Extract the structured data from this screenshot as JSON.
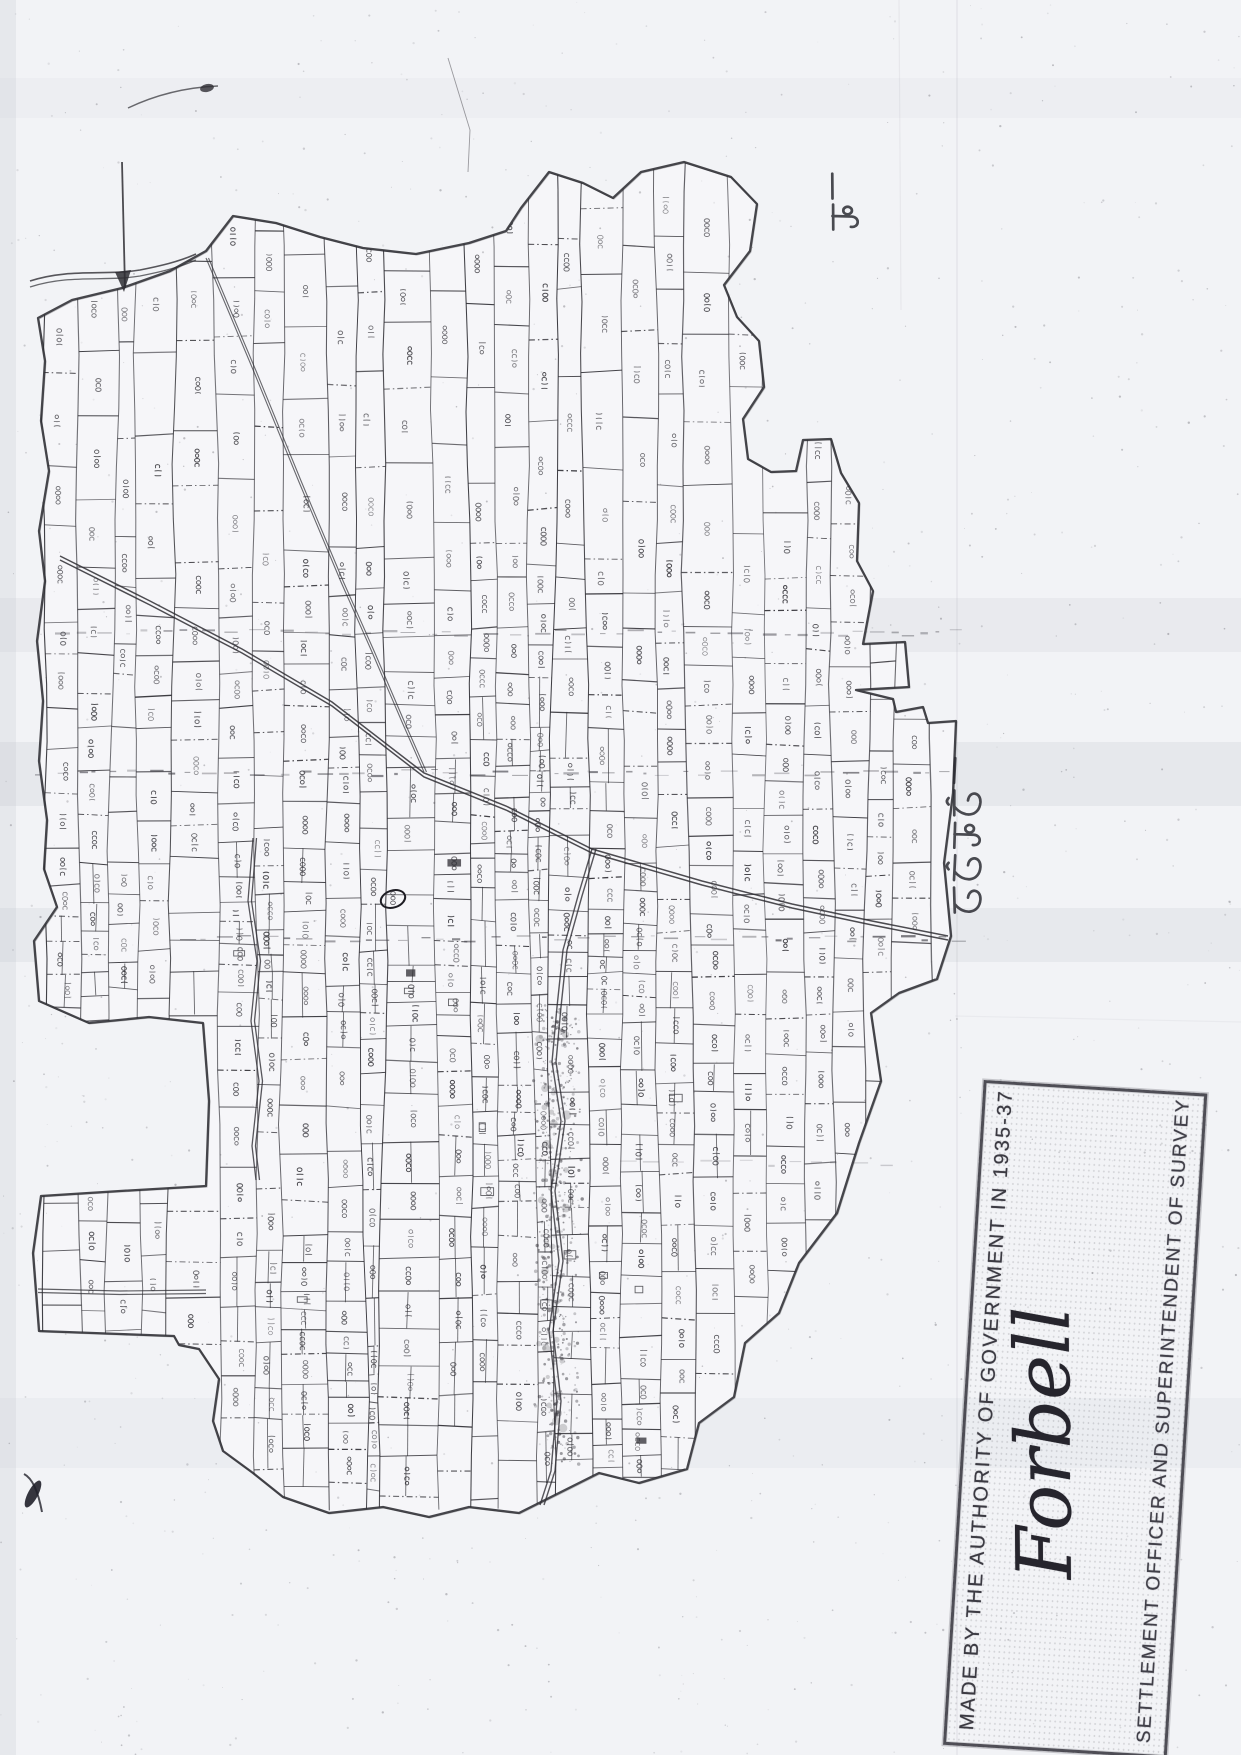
{
  "page": {
    "width": 1241,
    "height": 1755,
    "paper_color": "#f2f3f6",
    "ink_color": "#2e2d33",
    "kind_visible": "photocopied hand-drawn cadastral (mouza) plot map"
  },
  "map": {
    "region_labels": [
      {
        "id": "north-adjacent-mouza",
        "text": "ভাদগাঁও নং ৫",
        "orientation": "vertical, reads bottom-to-top",
        "position": "top-right edge"
      },
      {
        "id": "east-adjacent-mouza",
        "text": "ভেড়তৈল নং ২১",
        "orientation": "vertical, reads bottom-to-top",
        "position": "middle-right edge"
      }
    ],
    "circled_plot_number": "৩৬০৯",
    "parcel_number_script": "Bengali numerals, written rotated 90° (read bottom-to-top)",
    "legible_parcel_numbers_sample": [
      "৬৬৩",
      "৬৬৪",
      "৬৬৫",
      "৬৯৮",
      "৭৫২",
      "৮৪১",
      "১৬৪৯",
      "১৯০৮",
      "২৬০৯",
      "২৯৪৫",
      "৩৮০১",
      "৩৮৬৯",
      "৩৯৪৫",
      "৫০৯২",
      "৫২৪১",
      "৫৩০৮"
    ]
  },
  "stamp": {
    "line1": "MADE BY THE AUTHORITY OF GOVERNMENT IN 1935-37",
    "signature": "Forbell",
    "line2": "SETTLEMENT OFFICER AND SUPERINTENDENT OF SURVEY",
    "orientation": "rotated, reads bottom-to-top",
    "position": "bottom-right"
  }
}
